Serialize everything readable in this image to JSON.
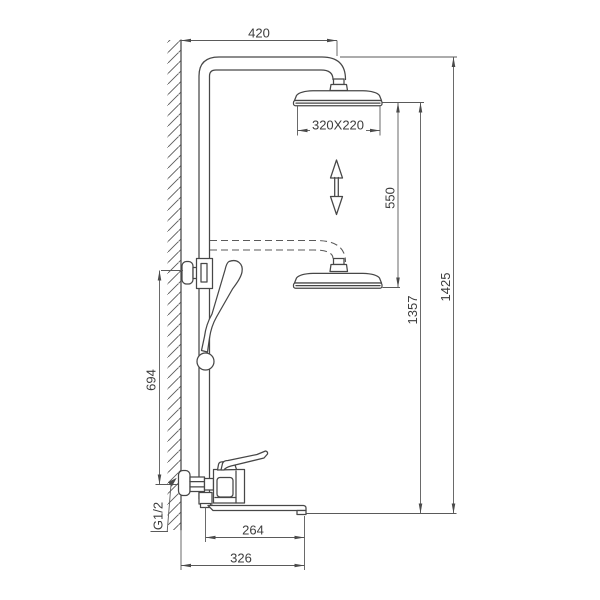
{
  "page": {
    "background": "#ffffff",
    "line_color": "#474747",
    "dimension_line_color": "#5a5a5a",
    "text_color": "#3c3c3c"
  },
  "drawing": {
    "type": "technical-dimension-drawing",
    "subject": "wall-mounted shower column with overhead shower, hand shower and bath mixer",
    "dimensions": {
      "arm_reach": "420",
      "head_size": "320X220",
      "height_adjustment": "550",
      "head_height": "1357",
      "total_height": "1425",
      "bracket_height": "694",
      "inlet_thread": "G1/2",
      "spout_reach": "264",
      "overall_depth": "326"
    }
  }
}
